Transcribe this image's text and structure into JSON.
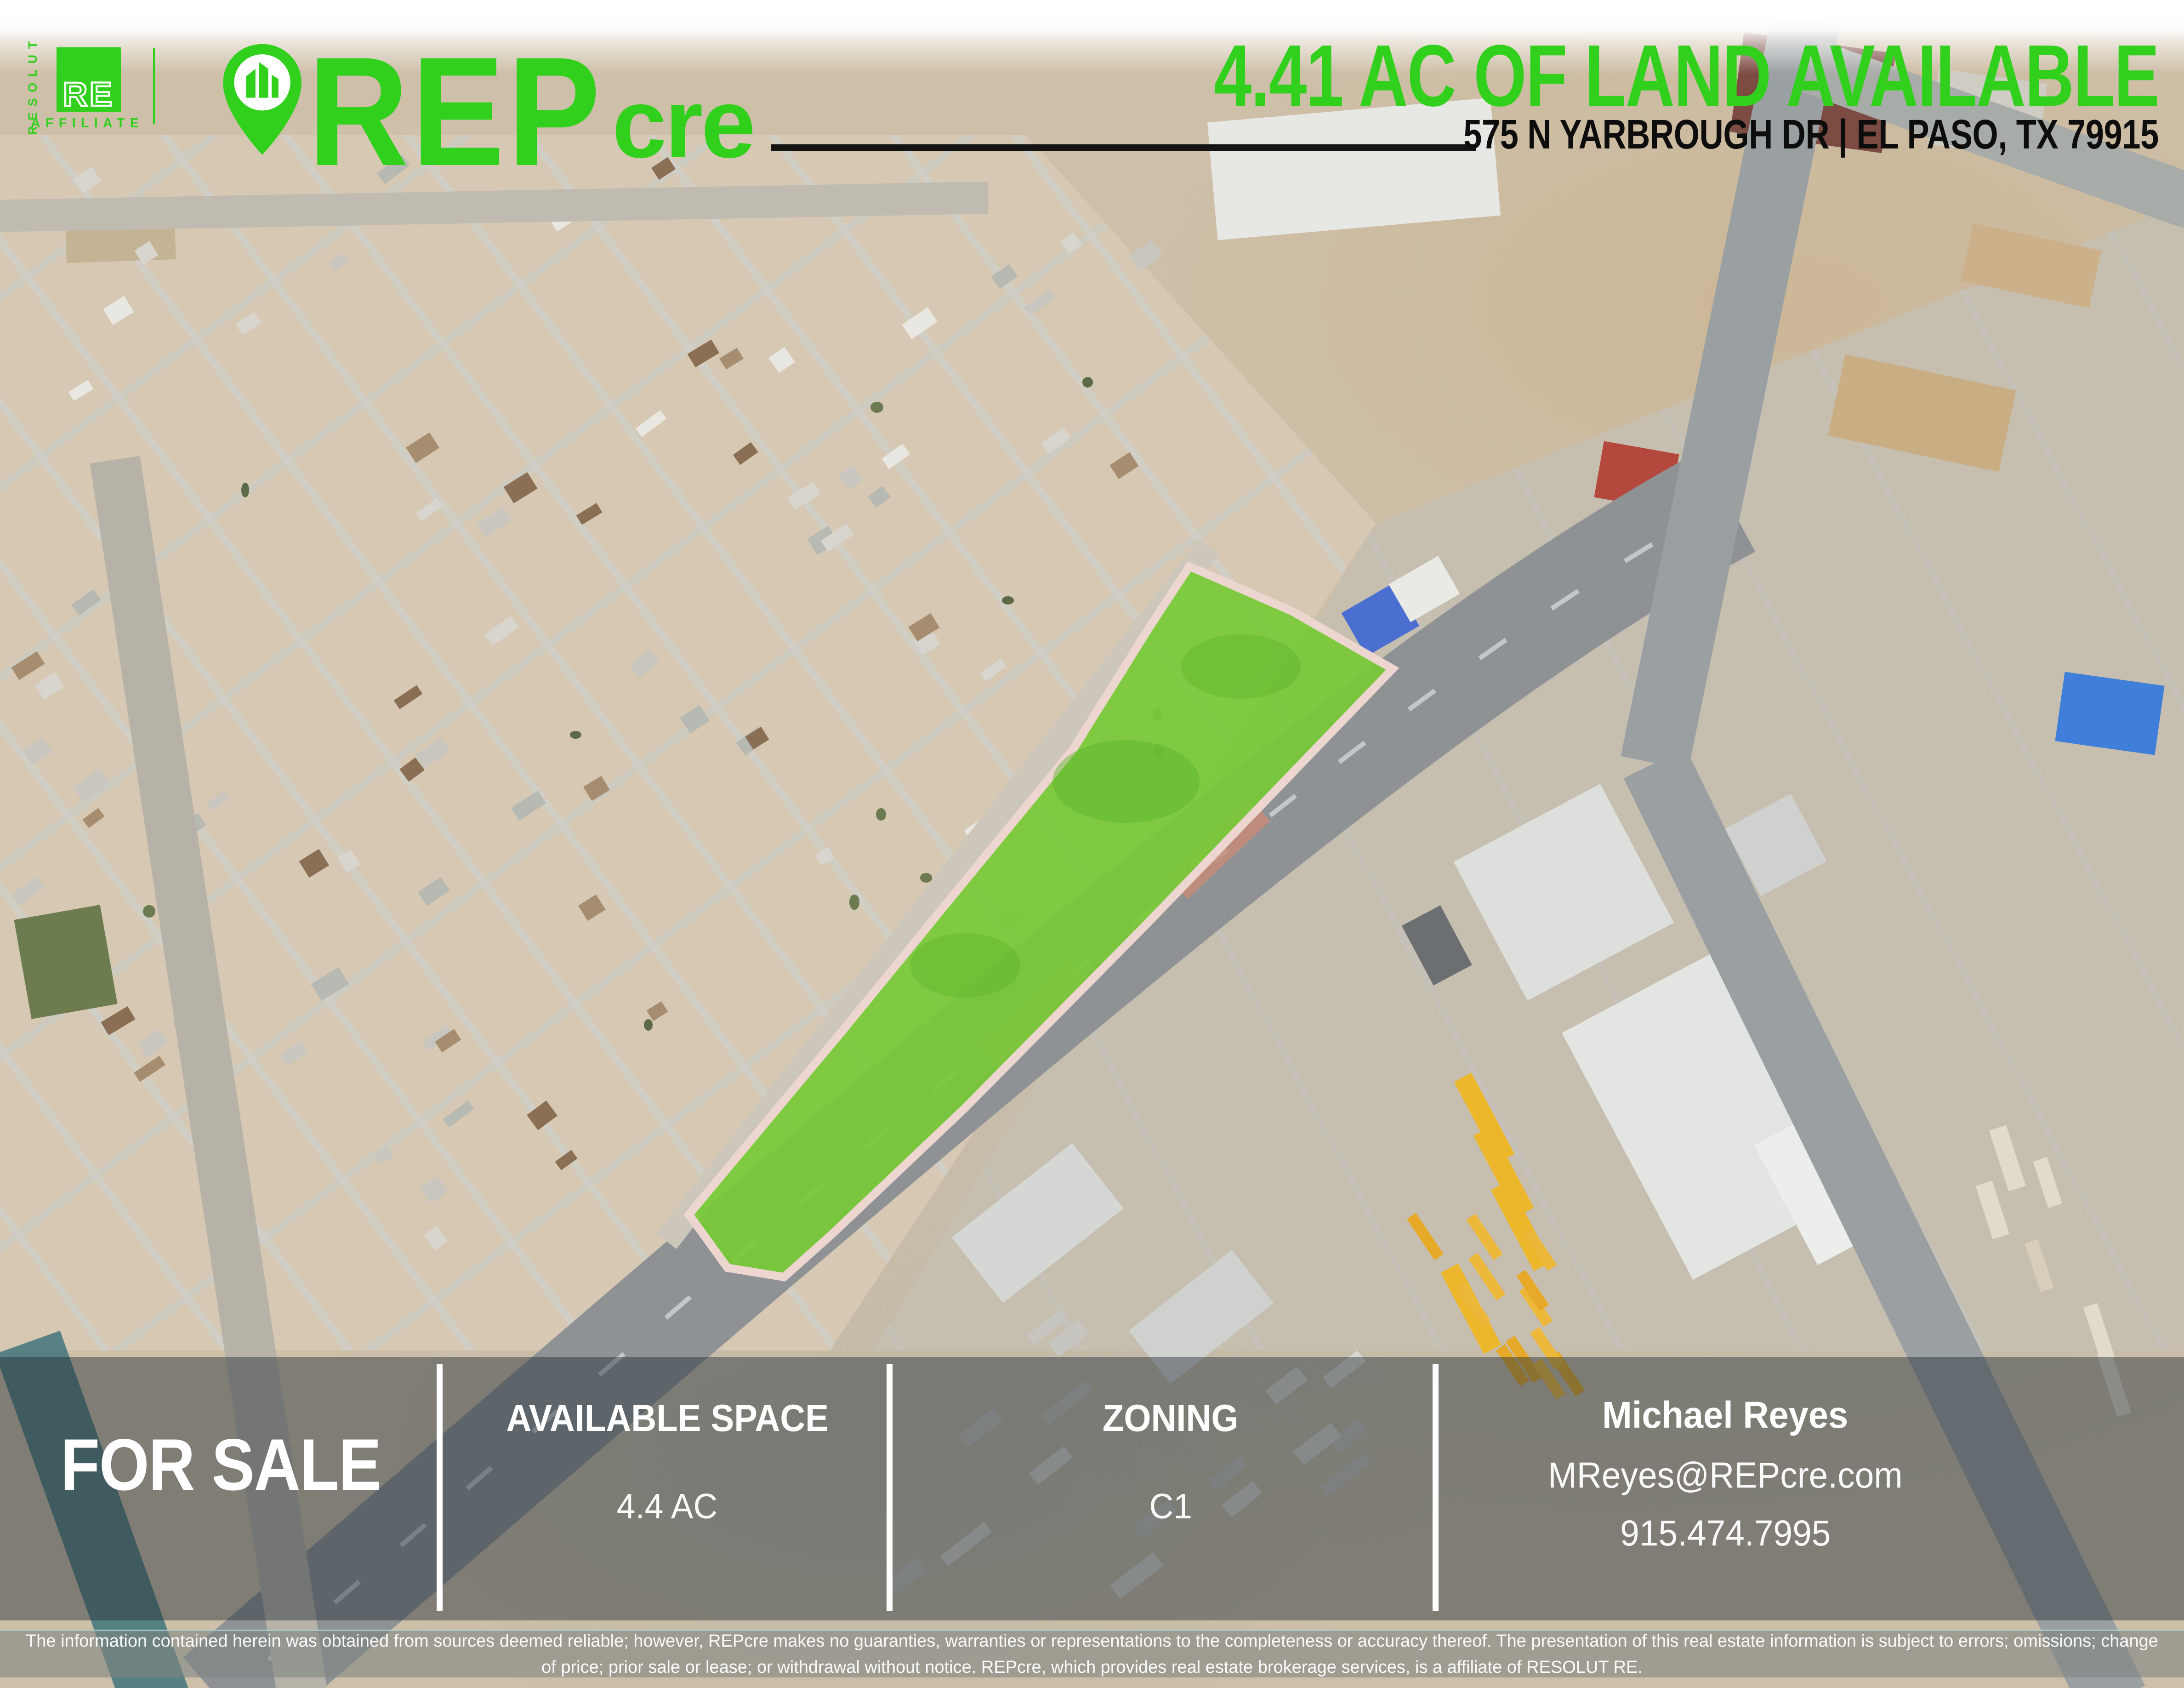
{
  "brand": {
    "resolut_vertical": "RESOLUT",
    "re_box": "RE",
    "affiliate": "AFFILIATE",
    "logo_main": "REP",
    "logo_sub": "cre",
    "green": "#31d01c",
    "parcel_green": "#77ca36"
  },
  "header": {
    "title": "4.41 AC OF LAND AVAILABLE",
    "address": "575 N YARBROUGH DR | EL PASO, TX 79915"
  },
  "banner": {
    "for_sale": "FOR SALE",
    "sections": [
      {
        "label": "AVAILABLE SPACE",
        "value": "4.4 AC"
      },
      {
        "label": "ZONING",
        "value": "C1"
      }
    ],
    "contact": {
      "name": "Michael Reyes",
      "email": "MReyes@REPcre.com",
      "phone": "915.474.7995"
    }
  },
  "footer": {
    "disclaimer": "The information contained herein was obtained from sources deemed reliable; however, REPcre makes no guaranties, warranties or representations to the completeness or accuracy thereof. The presentation of this real estate information is subject to errors; omissions; change of price; prior sale or lease; or withdrawal without notice. REPcre, which provides real estate brokerage services, is a affiliate of RESOLUT RE."
  }
}
